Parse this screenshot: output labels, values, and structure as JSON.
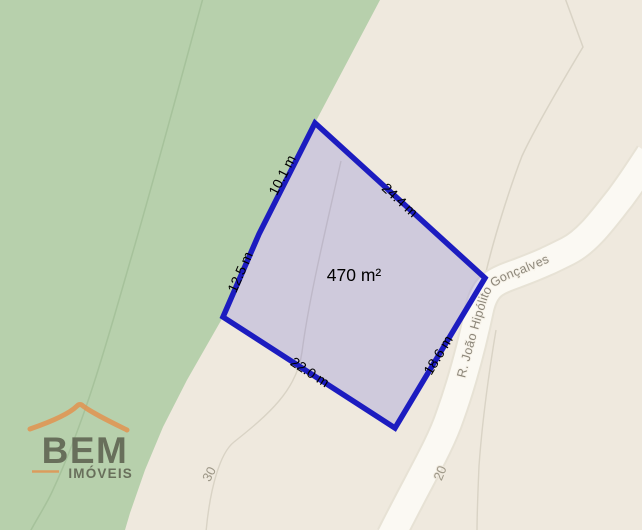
{
  "map": {
    "area_label": "470 m²",
    "edge_labels": {
      "upper_left": "10.1 m",
      "upper_right": "24.4 m",
      "right": "18.6 m",
      "bottom": "22.0 m",
      "left": "12.5 m"
    },
    "street": {
      "name": "R. João Hipólito Gonçalves",
      "numbers": {
        "left": "30",
        "right": "20"
      }
    },
    "colors": {
      "land": "#efe9de",
      "park": "#b7d0ac",
      "road": "#fbf9f3",
      "road_casing": "#e7e2d5",
      "parcel_line": "#d9d3c5",
      "lot_stroke": "#1c1cc0",
      "lot_fill": "rgba(95,92,215,0.22)",
      "map_label_gray": "#9d9787",
      "dimension_text": "#000000"
    }
  },
  "watermark": {
    "brand": "BEM",
    "tagline": "IMÓVEIS",
    "accent_color": "#e19552",
    "text_color": "#5d6150"
  }
}
